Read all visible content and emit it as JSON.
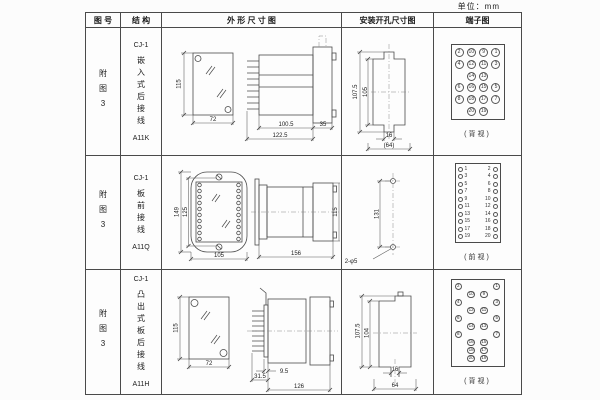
{
  "unit_label": "单位：mm",
  "colors": {
    "line": "#4a4a4a",
    "text": "#222222",
    "background": "#fcfcfc"
  },
  "table": {
    "headers": [
      "图 号",
      "结 构",
      "外 形 尺 寸 图",
      "安装开孔尺寸图",
      "端子图"
    ]
  },
  "rows": [
    {
      "fig_no": "附图3",
      "structure": {
        "model": "CJ-1",
        "desc": "嵌入式后接线",
        "code": "A11K"
      },
      "outline": {
        "front_h": "115",
        "front_w": "72",
        "d1": "100.5",
        "d2": "122.5",
        "d3": "35"
      },
      "install": {
        "outer_h": "107.5",
        "inner_h": "105",
        "notch": "16",
        "width": "(64)"
      }
    },
    {
      "fig_no": "附图3",
      "structure": {
        "model": "CJ-1",
        "desc": "板前接线",
        "code": "A11Q"
      },
      "outline": {
        "front_outer_h": "149",
        "front_inner_h": "125",
        "front_w": "105",
        "side_len": "156",
        "side_h": "115"
      },
      "install": {
        "spacing": "131",
        "holes": "2-φ5"
      }
    },
    {
      "fig_no": "附图3",
      "structure": {
        "model": "CJ-1",
        "desc": "凸出式板后接线",
        "code": "A11H"
      },
      "outline": {
        "front_h": "115",
        "front_w": "72",
        "d1": "9.5",
        "d2": "31.5",
        "d3": "126"
      },
      "install": {
        "outer_h": "107.5",
        "inner_h": "104",
        "notch": "16",
        "width": "64"
      }
    }
  ],
  "terminals": {
    "a11k": {
      "kind": "grid",
      "caption": "(背视)",
      "rows": [
        [
          "2",
          "10",
          "9",
          "1"
        ],
        [
          "4",
          "12",
          "11",
          "3"
        ],
        [
          "",
          "14",
          "13",
          ""
        ],
        [
          "6",
          "16",
          "15",
          "5"
        ],
        [
          "8",
          "18",
          "17",
          "7"
        ],
        [
          "",
          "20",
          "19",
          ""
        ]
      ]
    },
    "a11q": {
      "kind": "pairs",
      "caption": "(前视)",
      "rows": [
        [
          "1",
          "2"
        ],
        [
          "3",
          "4"
        ],
        [
          "5",
          "6"
        ],
        [
          "7",
          "8"
        ],
        [
          "9",
          "10"
        ],
        [
          "11",
          "12"
        ],
        [
          "13",
          "14"
        ],
        [
          "15",
          "16"
        ],
        [
          "17",
          "18"
        ],
        [
          "19",
          "20"
        ]
      ]
    },
    "a11h": {
      "kind": "grid",
      "caption": "(背视)",
      "rows": [
        [
          "2",
          "",
          "",
          "1"
        ],
        [
          "",
          "10",
          "9",
          ""
        ],
        [
          "4",
          "",
          "",
          "3"
        ],
        [
          "",
          "12",
          "11",
          ""
        ],
        [
          "6",
          "",
          "",
          "5"
        ],
        [
          "",
          "14",
          "13",
          ""
        ],
        [
          "8",
          "",
          "",
          "7"
        ],
        [
          "",
          "16",
          "15",
          ""
        ],
        [
          "",
          "18",
          "17",
          ""
        ],
        [
          "",
          "20",
          "19",
          ""
        ]
      ]
    }
  }
}
